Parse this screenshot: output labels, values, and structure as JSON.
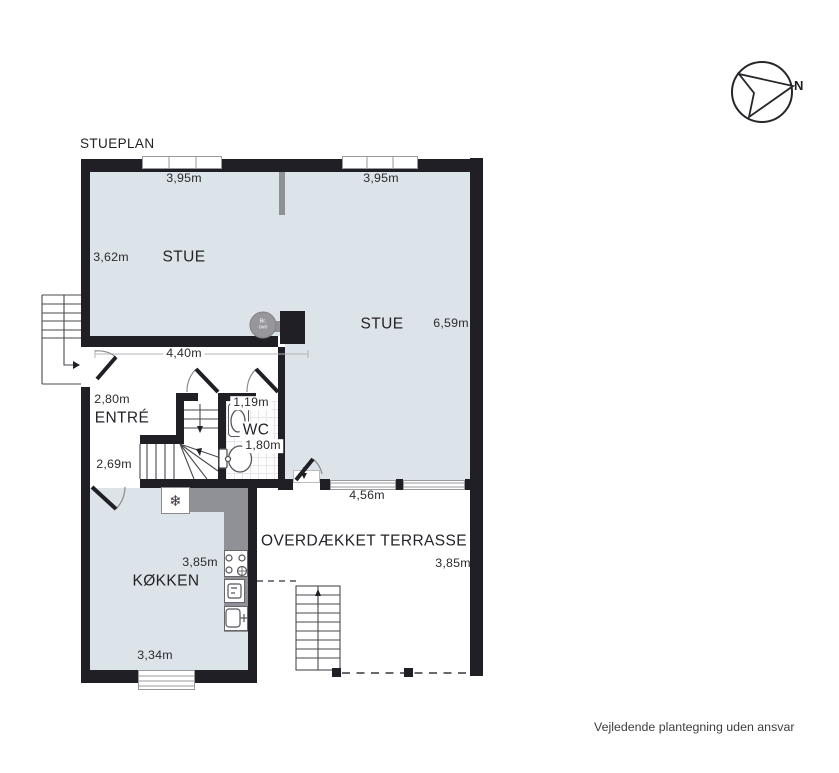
{
  "title": "STUEPLAN",
  "footer_disclaimer": "Vejledende plantegning uden ansvar",
  "compass": {
    "north_label": "N"
  },
  "rooms": {
    "stue_left": "STUE",
    "stue_right": "STUE",
    "entre": "ENTRÉ",
    "wc": "WC",
    "kokken": "KØKKEN",
    "terrasse": "OVERDÆKKET TERRASSE"
  },
  "dimensions": {
    "stue_left_top": "3,95m",
    "stue_right_top": "3,95m",
    "stue_left_side": "3,62m",
    "stue_right_side": "6,59m",
    "stue_opening": "4,40m",
    "entre_side": "2,80m",
    "entre_bottom": "2,69m",
    "wc_top": "1,19m",
    "wc_side": "1,80m",
    "terrasse_top": "4,56m",
    "terrasse_side": "3,85m",
    "kokken_side": "3,85m",
    "kokken_bottom": "3,34m"
  },
  "fixtures": {
    "wood_stove": "Br.\novn",
    "freezer_icon": "❄"
  },
  "colors": {
    "wall": "#1f1f25",
    "floor": "#dce3e9",
    "counter": "#8f9196",
    "outline": "#55555a",
    "winline": "#9a9a9e"
  }
}
